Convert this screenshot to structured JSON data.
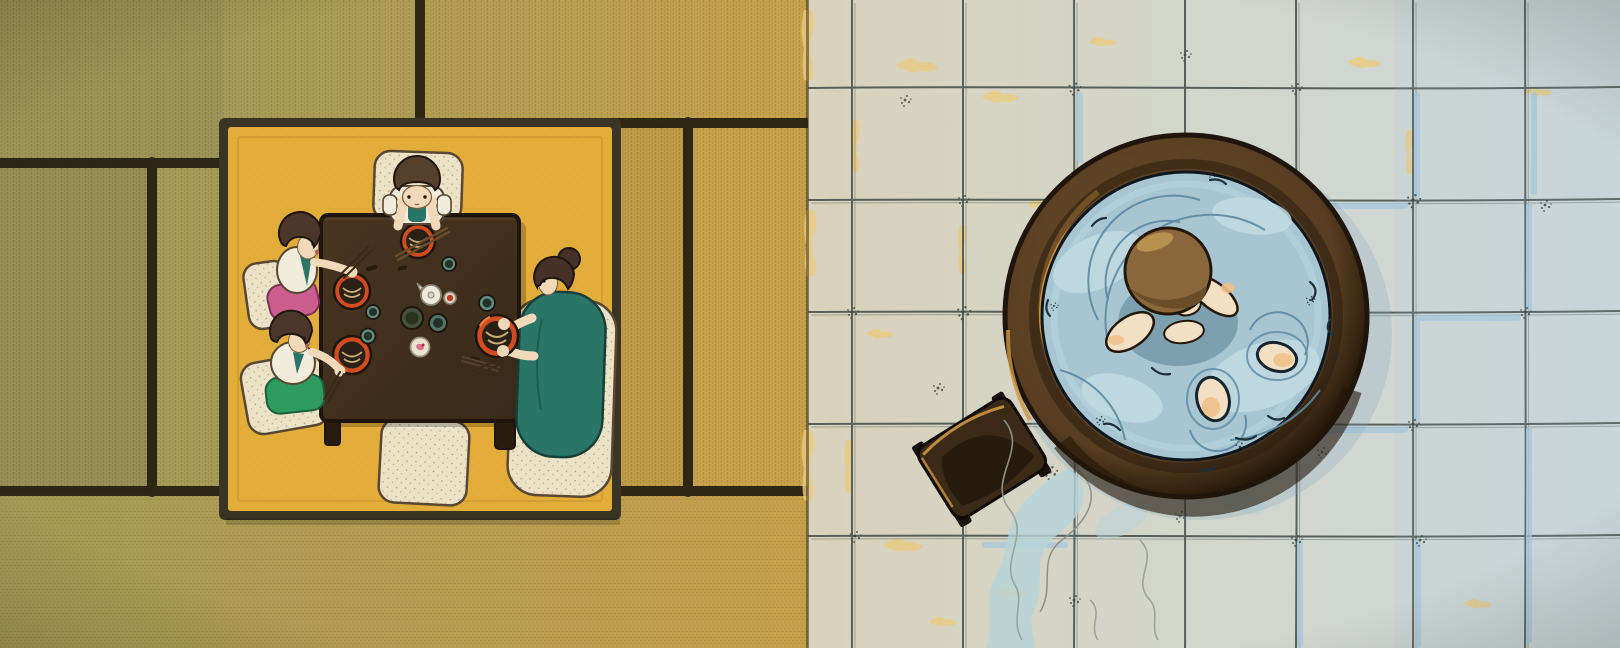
{
  "title": "Top-down illustration diptych: a family of four eats noodles around a low dark wooden table on a yellow rug over tatami mats (left); a child soaks in a round wooden bathtub on a tiled bathroom floor beside a small wooden stool (right)",
  "panels": {
    "left": {
      "label": "dining-room-tatami",
      "description": "Four figures seated on cream floor cushions around a square chabudai table set with red noodle bowls, teacups, a white pot, soy sauce bottle and pickle plate; one empty cushion at the bottom"
    },
    "right": {
      "label": "bathroom-tile-floor",
      "description": "Round wooden ofuro tub full of pale blue water; a child's head, arms and two knees break the surface; a dark wooden bath stool sits lower-left with a water trail and steam wisps"
    }
  },
  "figures": [
    "boy-at-table",
    "girl-left",
    "girl-front",
    "mother",
    "child-in-bath"
  ],
  "items": [
    "low-table",
    "floor-cushion x5",
    "red-noodle-bowl x4",
    "teacup x4",
    "white-pot",
    "soy-sauce-bottle",
    "greens-dish",
    "pickle-plate",
    "chopsticks",
    "wooden-tub",
    "bath-stool"
  ],
  "colors": {
    "ink": "#1f150d",
    "seam": "#241e0e",
    "tat_olive": "#9a9356",
    "tat_olive2": "#a49a58",
    "tat_gold": "#c7a04a",
    "tat_gold2": "#bf9a45",
    "tat_mid": "#948e55",
    "tat_mid2": "#a59b58",
    "rug_yellow": "#e3ad39",
    "rug_border": "#3a3424",
    "rug_crease": "#c8922e",
    "table": "#41301f",
    "table_leg": "#281c10",
    "cushion": "#ebe2c7",
    "cushion_edge": "#584732",
    "cloth_white": "#f2ecdc",
    "teal": "#2b7568",
    "pink": "#cb5d8f",
    "green": "#2f9a5e",
    "skin": "#f1d9ba",
    "hair_dark": "#4b372a",
    "hair_boy": "#55402b",
    "hair_mother": "#443127",
    "bowl_red": "#d14d20",
    "bowl_dark": "#2a2015",
    "noodle": "#c9ad72",
    "cup_teal": "#5d8d7c",
    "cup_dark": "#243027",
    "dish_green": "#44523c",
    "plate_cream": "#ece4cf",
    "pickle": "#d9708e",
    "pot_white": "#efeade",
    "cap_red": "#c03a1e",
    "stick": "#6b4b2a",
    "stick_dark": "#3c2a18",
    "tile_warm": "#d9d2bc",
    "tile_cool": "#cdd7da",
    "grout": "#4a5450",
    "tile_shadow": "#a7c7dc",
    "stain": "#eacb7f",
    "speck": "#40483f",
    "rim": "#573d21",
    "rim_light": "#6b4c28",
    "rim_dark": "#241808",
    "gold": "#cd9641",
    "water": "#a7c6d2",
    "water_light": "#c3dce2",
    "ripple": "#5d89a3",
    "ink_water": "#1c2f3b",
    "water_shadow": "#4a7087",
    "skin_b": "#f2dfc4",
    "peach": "#f0c08a",
    "hairb": "#8a683c",
    "hairb_dark": "#6a4e2a",
    "hairb_hi": "#b8954f",
    "trail": "#b7d3da",
    "steam": "#979d92",
    "stool": "#3a2a16",
    "stool_dark": "#261a0d",
    "stool_leg": "#1b1209"
  }
}
